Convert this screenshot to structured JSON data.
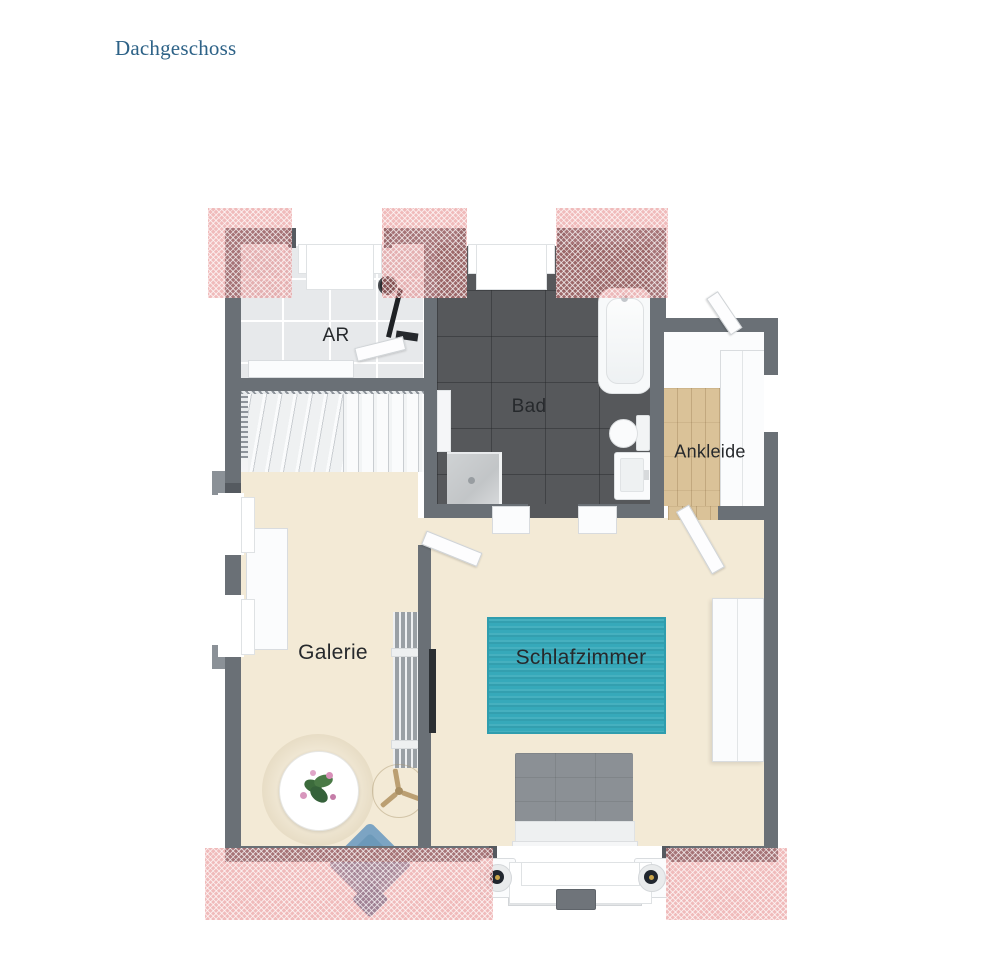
{
  "page": {
    "title": "Dachgeschoss"
  },
  "floorplan": {
    "rooms": [
      {
        "id": "ar",
        "label": "AR"
      },
      {
        "id": "bad",
        "label": "Bad"
      },
      {
        "id": "ankleide",
        "label": "Ankleide"
      },
      {
        "id": "galerie",
        "label": "Galerie"
      },
      {
        "id": "schlafzimmer",
        "label": "Schlafzimmer"
      }
    ],
    "colors": {
      "title_blue": "#2d6287",
      "wall_gray": "#6a7076",
      "floor_beige": "#f3ead6",
      "floor_bathroom": "#56585b",
      "floor_tile_white": "#e7e9eb",
      "floor_wood": "#dac298",
      "rug_teal": "#36a9ba",
      "roof_slope_marker_pink": "#e27878",
      "bed_gray": "#8b9095",
      "chair_blue": "#7ba3c2"
    }
  }
}
